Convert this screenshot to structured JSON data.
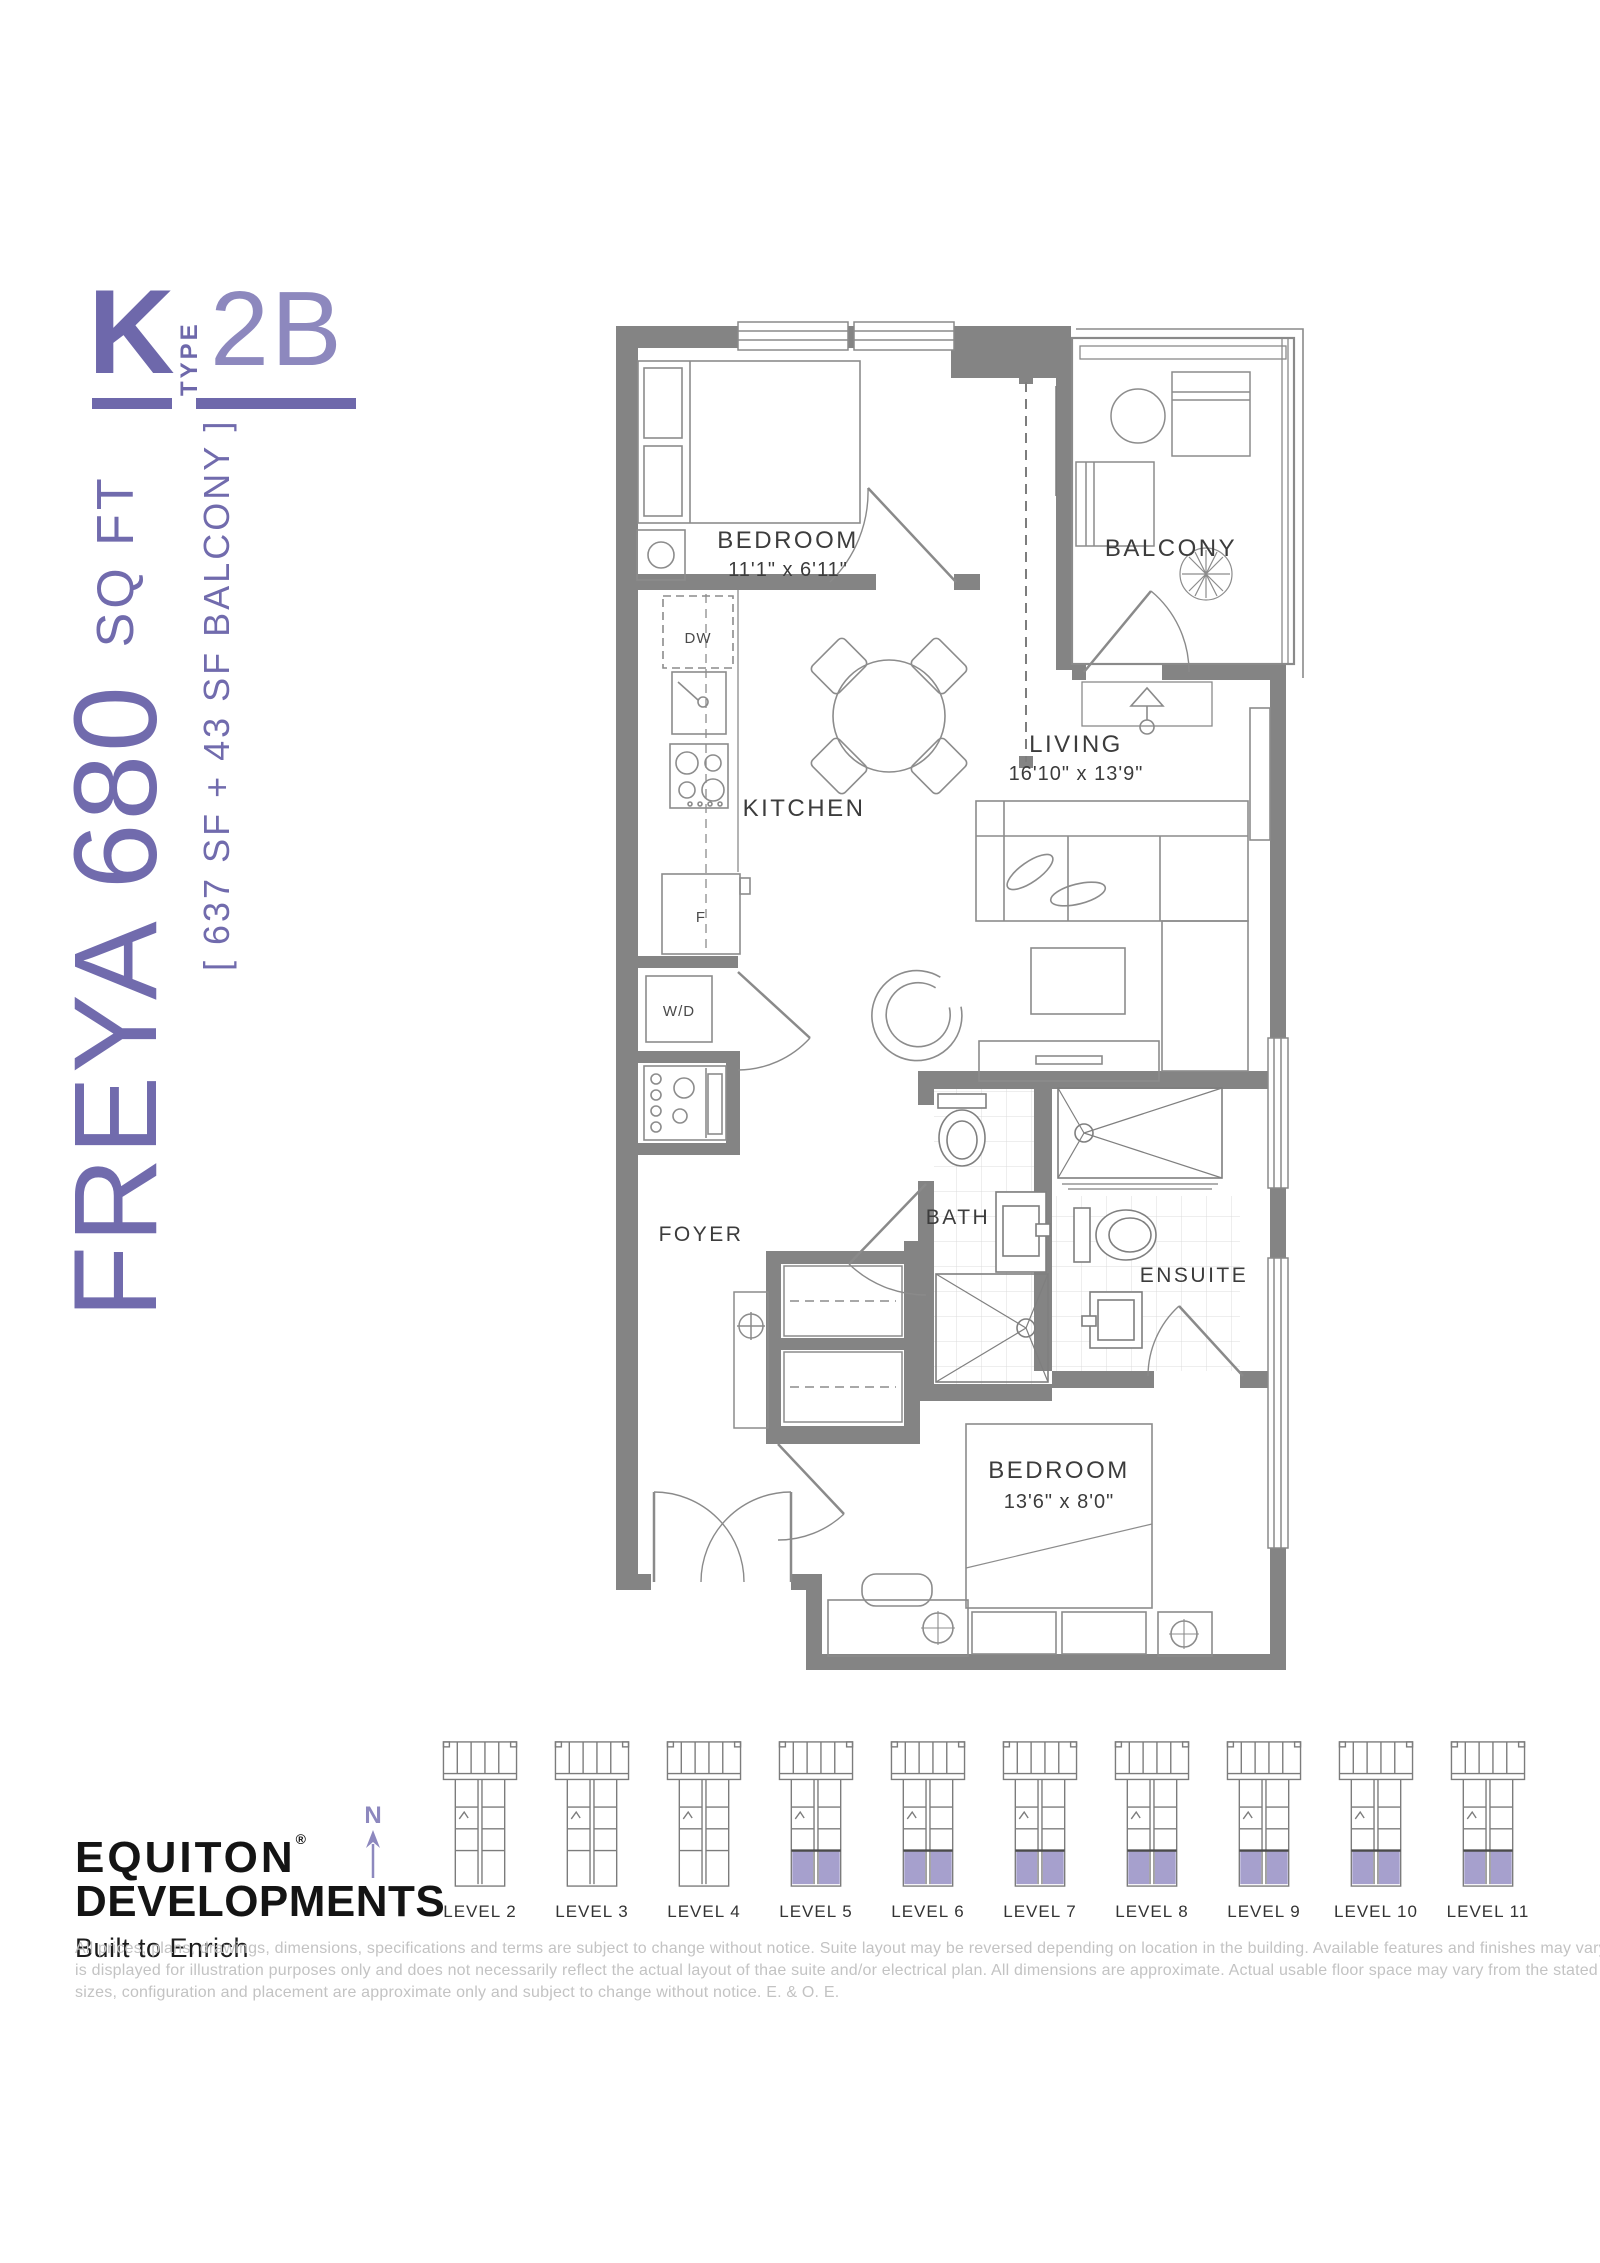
{
  "header": {
    "plan_letter": "K",
    "type_label": "TYPE",
    "type_value": "2B"
  },
  "side_label": {
    "area_big": "FREYA 680 ",
    "area_small": "SQ FT",
    "area_note": "[ 637 SF + 43 SF BALCONY ]"
  },
  "floor_plan": {
    "bedroom1": {
      "name": "BEDROOM",
      "dims": "11'1\" x 6'11\""
    },
    "balcony": {
      "name": "BALCONY"
    },
    "living": {
      "name": "LIVING",
      "dims": "16'10\" x 13'9\""
    },
    "kitchen": {
      "name": "KITCHEN"
    },
    "foyer": {
      "name": "FOYER"
    },
    "bath": {
      "name": "BATH"
    },
    "ensuite": {
      "name": "ENSUITE"
    },
    "bedroom2": {
      "name": "BEDROOM",
      "dims": "13'6\" x 8'0\""
    },
    "labels": {
      "dishwasher": "DW",
      "fridge": "F",
      "washer_dryer": "W/D"
    }
  },
  "levels": {
    "north_label": "N",
    "items": [
      {
        "label": "LEVEL 2",
        "highlighted": false
      },
      {
        "label": "LEVEL 3",
        "highlighted": false
      },
      {
        "label": "LEVEL 4",
        "highlighted": false
      },
      {
        "label": "LEVEL 5",
        "highlighted": true
      },
      {
        "label": "LEVEL 6",
        "highlighted": true
      },
      {
        "label": "LEVEL 7",
        "highlighted": true
      },
      {
        "label": "LEVEL 8",
        "highlighted": true
      },
      {
        "label": "LEVEL 9",
        "highlighted": true
      },
      {
        "label": "LEVEL 10",
        "highlighted": true
      },
      {
        "label": "LEVEL 11",
        "highlighted": true
      }
    ]
  },
  "footer": {
    "brand_line1": "EQUITON",
    "brand_reg": "®",
    "brand_line2": "DEVELOPMENTS",
    "brand_tagline": "Built to Enrich",
    "disclaimer_lines": [
      "All prices, plans, drawings, dimensions, specifications and terms are subject to change without notice.  Suite layout may be reversed depending on location in the building.  Available features and finishes may vary from suite to suite.  Furniture",
      "is displayed for illustration purposes only and does not necessarily reflect the actual layout of thae suite and/or electrical plan.  All dimensions are approximate.  Actual usable floor space may vary from the stated floor area.  Balcony/terrace",
      "sizes, configuration and placement are approximate only and subject to change without notice.  E. & O. E."
    ]
  },
  "colors": {
    "accent_purple": "#6E68AB",
    "accent_light": "#8D88BE",
    "level_highlight": "#9C96C8",
    "wall_gray": "#848484"
  }
}
